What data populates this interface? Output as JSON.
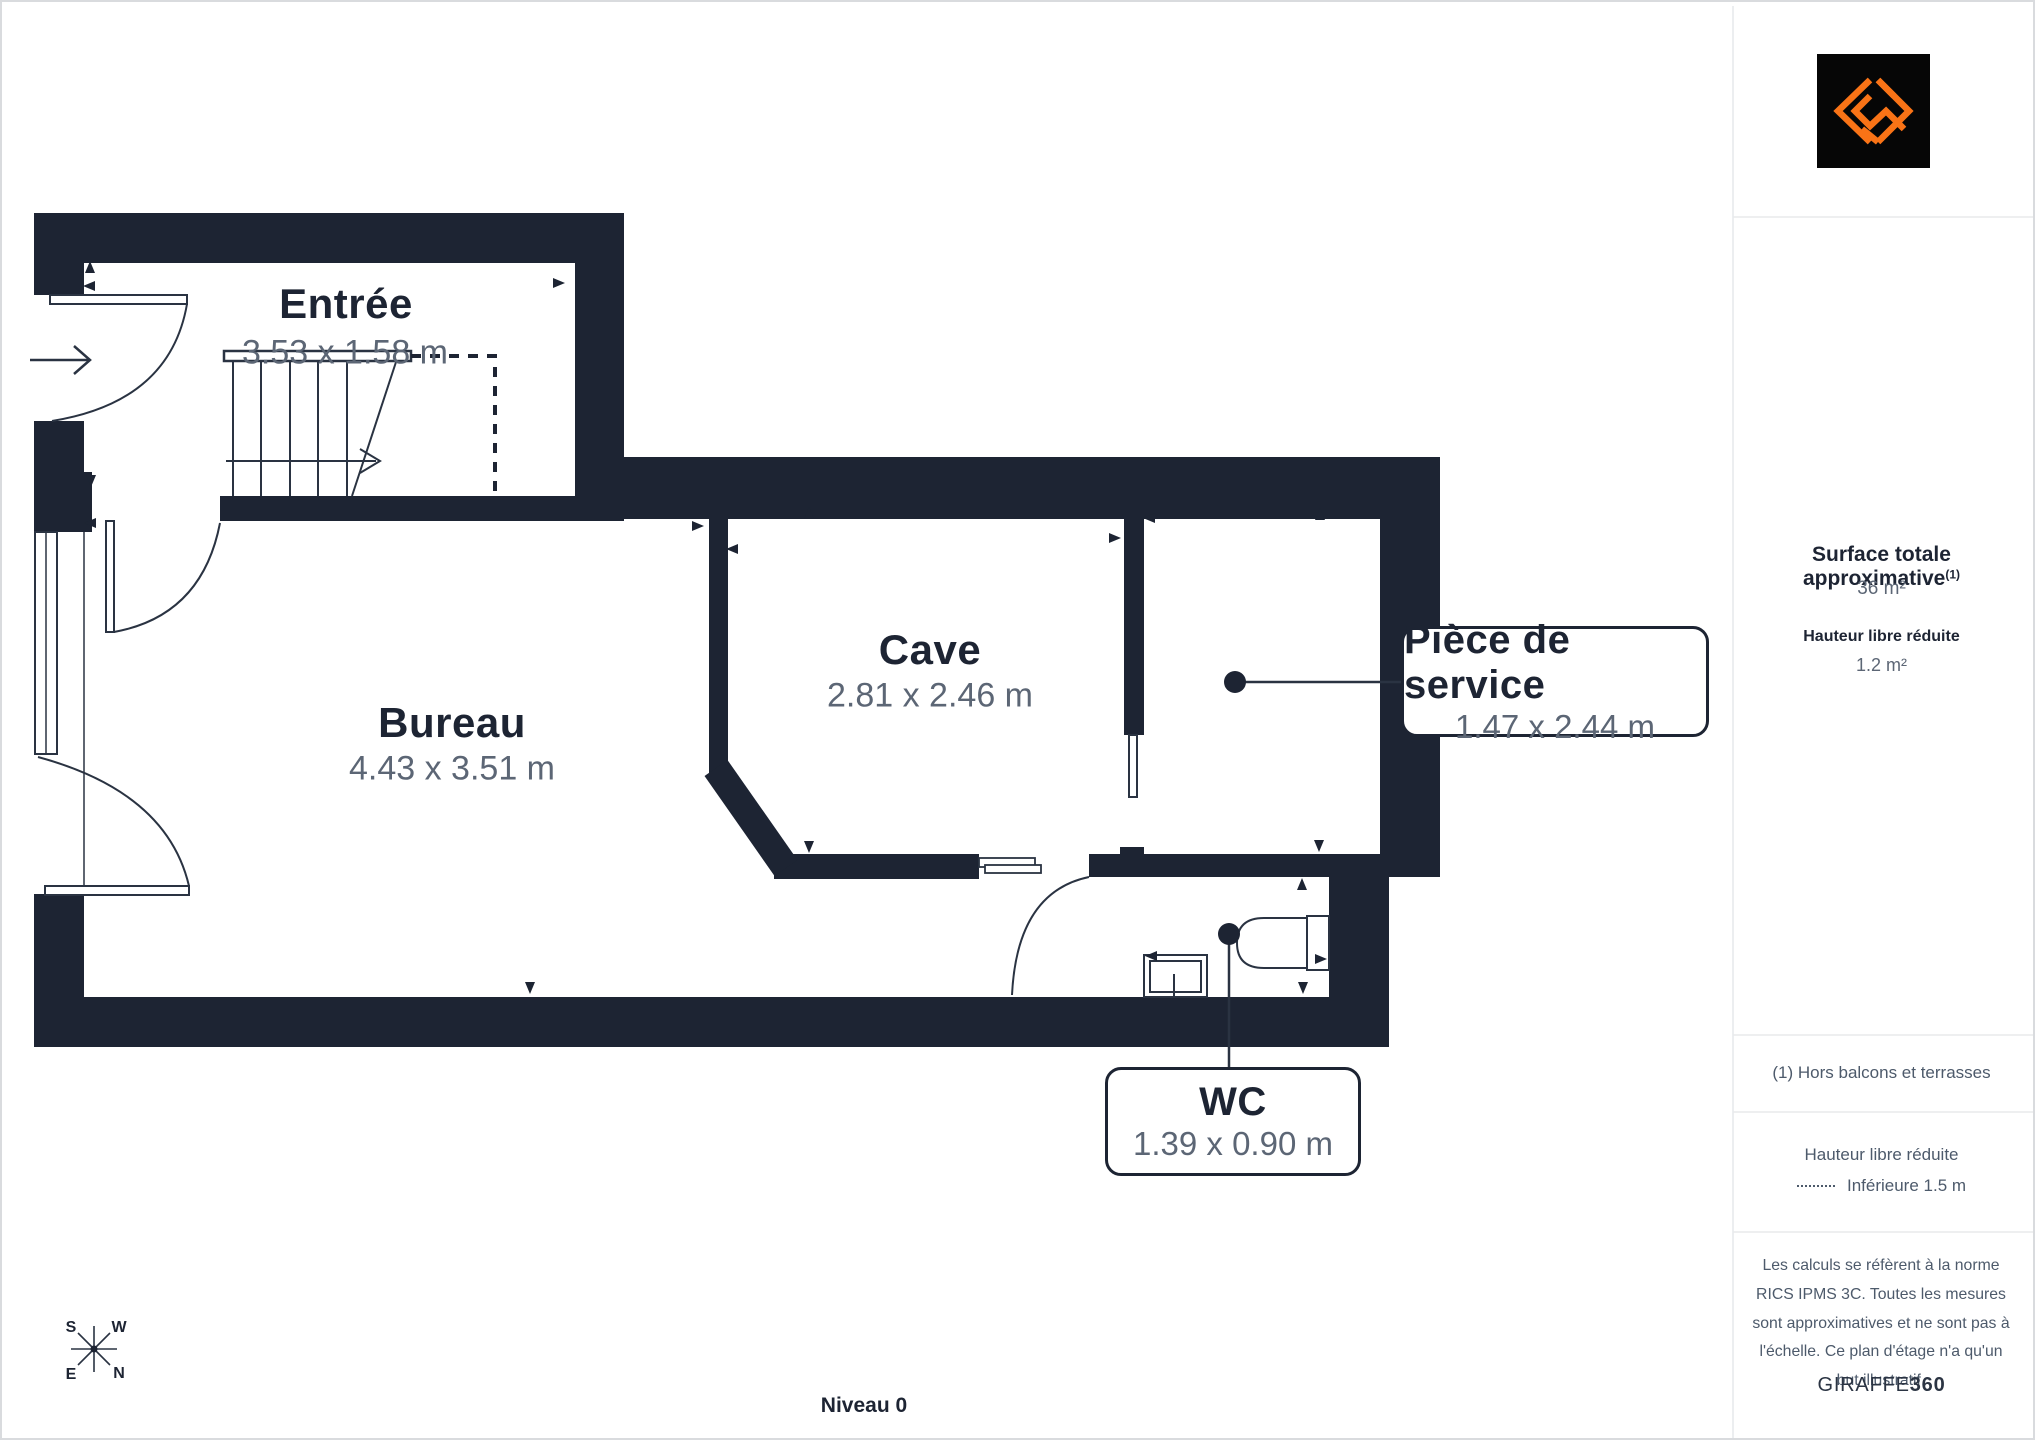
{
  "plan": {
    "level_label": "Niveau 0",
    "rooms": [
      {
        "name": "Entrée",
        "dims": "3.53 x 1.58 m"
      },
      {
        "name": "Bureau",
        "dims": "4.43 x 3.51 m"
      },
      {
        "name": "Cave",
        "dims": "2.81 x 2.46 m"
      }
    ],
    "callouts": [
      {
        "name": "Pièce de service",
        "dims": "1.47 x 2.44 m"
      },
      {
        "name": "WC",
        "dims": "1.39 x 0.90 m"
      }
    ],
    "compass": {
      "n": "N",
      "s": "S",
      "e": "E",
      "w": "W"
    }
  },
  "sidebar": {
    "surface_title": "Surface totale approximative",
    "surface_sup": "(1)",
    "surface_value": "36 m²",
    "reduced_height_title": "Hauteur libre réduite",
    "reduced_height_value": "1.2 m²",
    "footnote": "(1) Hors balcons et terrasses",
    "legend_title": "Hauteur libre réduite",
    "legend_value": "Inférieure 1.5 m",
    "disclaimer": "Les calculs se réfèrent à la norme RICS IPMS 3C. Toutes les mesures sont approximatives et ne sont pas à l'échelle. Ce plan d'étage n'a qu'un but illustratif.",
    "brand_name": "GIRAFFE",
    "brand_suffix": "360"
  },
  "colors": {
    "wall": "#1d2433",
    "line": "#2a3342",
    "dim_text": "#5c6675",
    "divider": "#e8eaec",
    "accent_orange": "#f97316",
    "logo_bg": "#060606"
  }
}
